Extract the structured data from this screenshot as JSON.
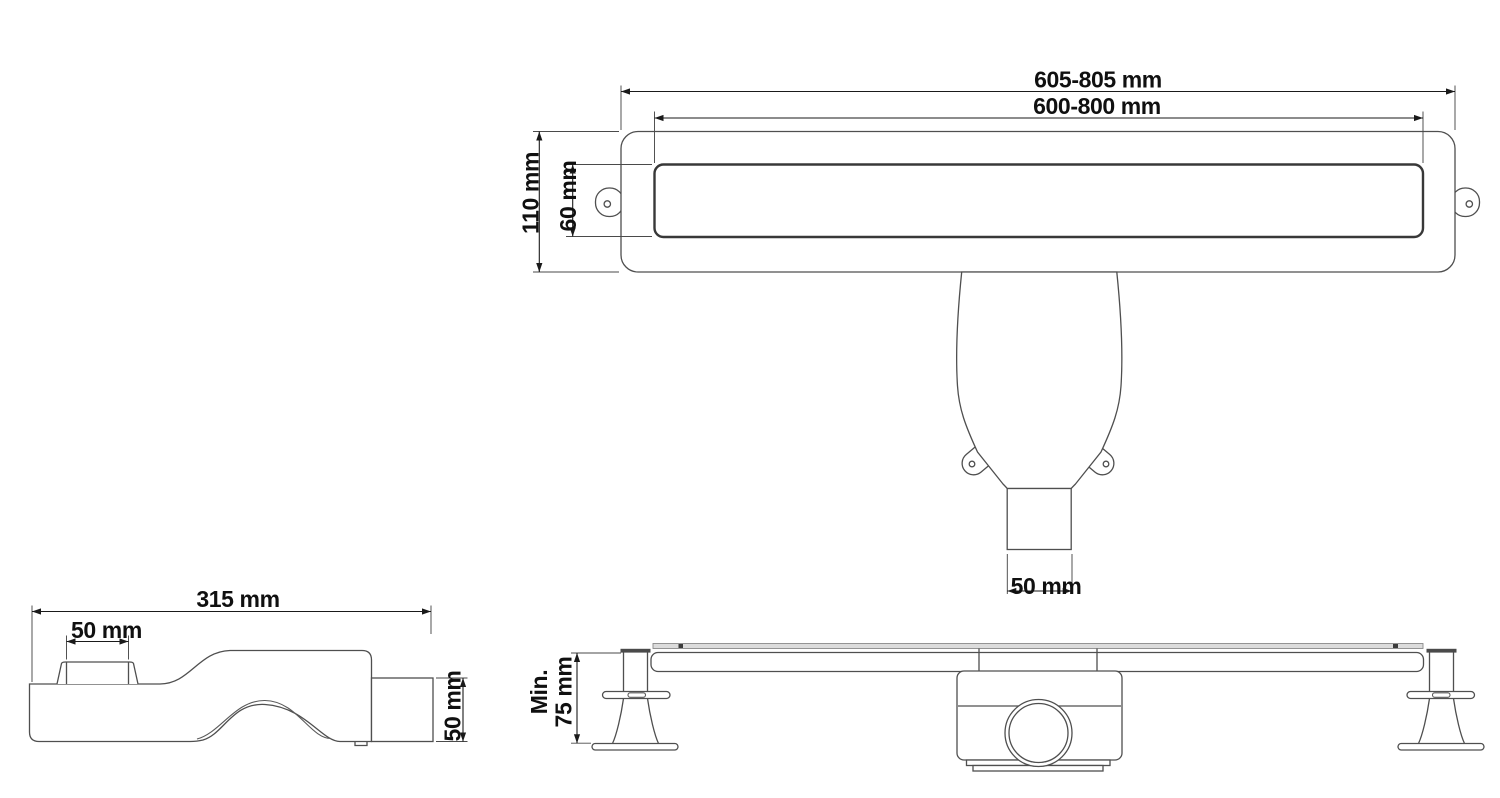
{
  "drawing": {
    "top_view": {
      "overall_length": "605-805 mm",
      "grate_length": "600-800 mm",
      "body_width": "110 mm",
      "grate_width": "60 mm",
      "outlet_width": "50 mm"
    },
    "trap_side_view": {
      "overall_length": "315 mm",
      "inlet_width": "50 mm",
      "outlet_height": "50 mm"
    },
    "channel_side_view": {
      "min_height_prefix": "Min.",
      "min_height_value": "75 mm"
    },
    "colors": {
      "outline": "#4f4f4f",
      "grate_outline": "#383838",
      "dimension": "#1a1a1a",
      "text": "#101010",
      "flange_fill": "#dcdcdc",
      "background": "#ffffff"
    }
  }
}
